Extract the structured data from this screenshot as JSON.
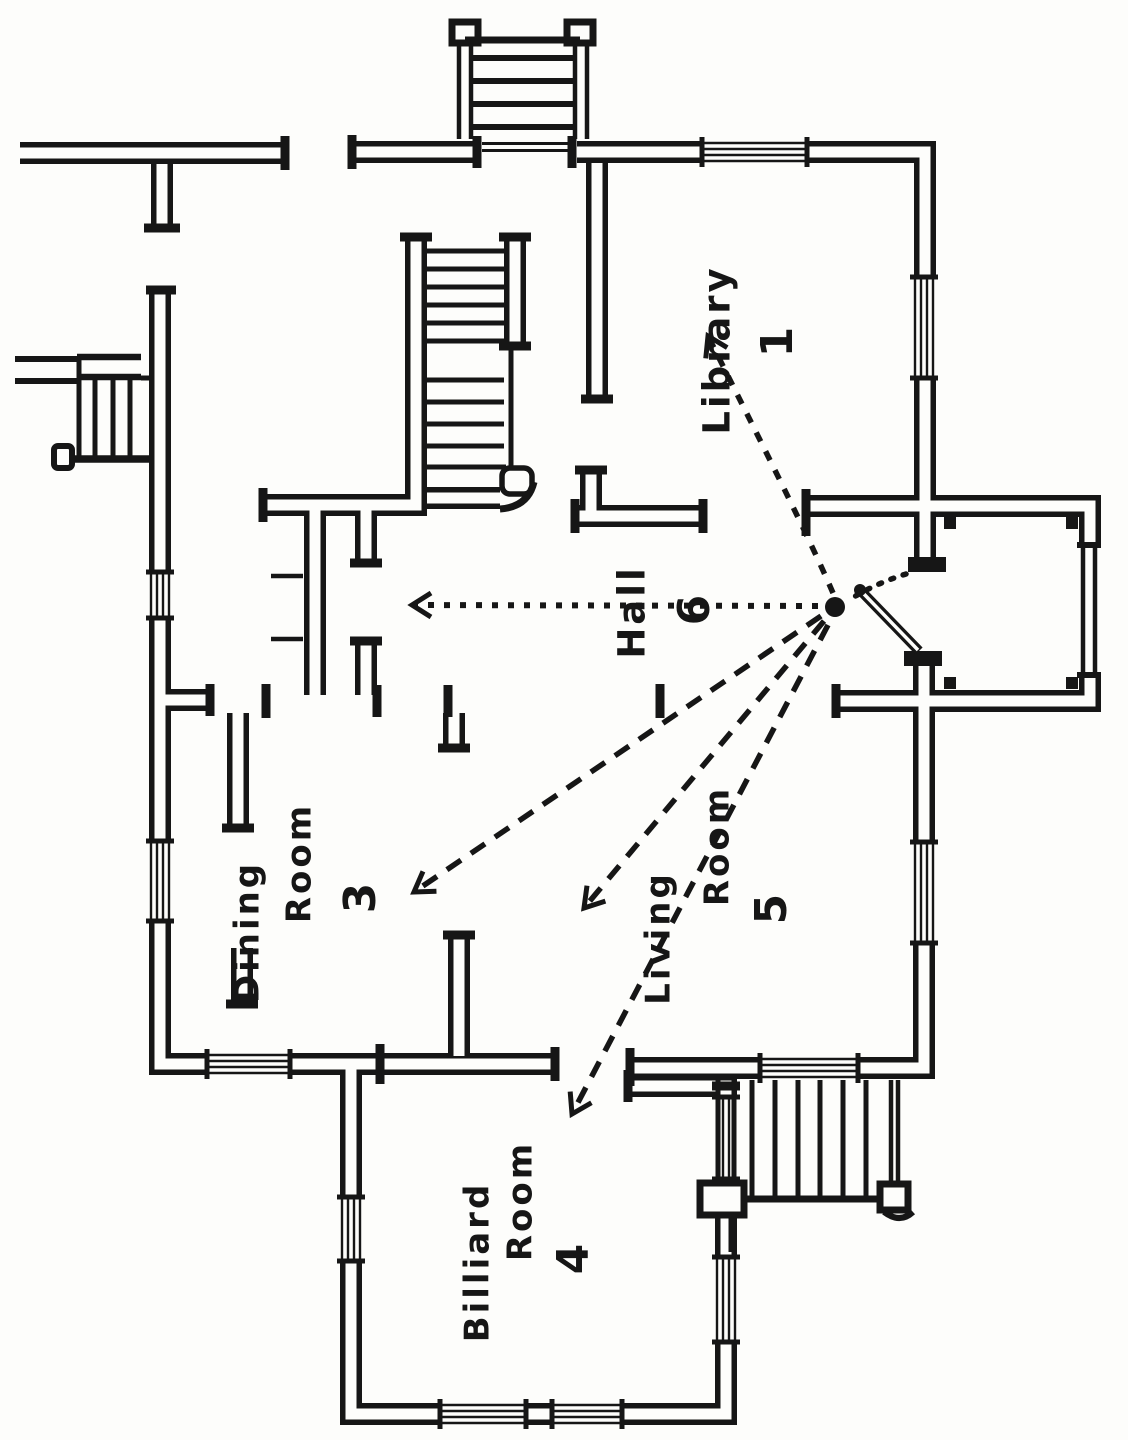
{
  "document": {
    "type": "hand-drawn floor plan (scanned book figure)",
    "orientation": "labels rotated 90° counter-clockwise (read bottom-to-top)"
  },
  "colors": {
    "ink": "#161616",
    "paper": "#fdfdfb"
  },
  "labels": {
    "library": {
      "name": "Library",
      "number": "1"
    },
    "hall": {
      "name": "Hall",
      "number": "6"
    },
    "dining": {
      "word1": "Dining",
      "word2": "Room",
      "number": "3"
    },
    "living": {
      "word1": "Living",
      "word2": "Room",
      "number": "5"
    },
    "billiard": {
      "word1": "Billiard",
      "word2": "Room",
      "number": "4"
    }
  },
  "annotations": {
    "origin_marker": "black dot at front entrance",
    "arrow_targets": [
      "Hall 6",
      "Library 1",
      "Dining Room 3",
      "Living Room 5",
      "Billiard Room 4"
    ],
    "entry_path": "dotted curve from vestibule doorway to dot",
    "door": "entrance door leaf swinging across vestibule"
  }
}
